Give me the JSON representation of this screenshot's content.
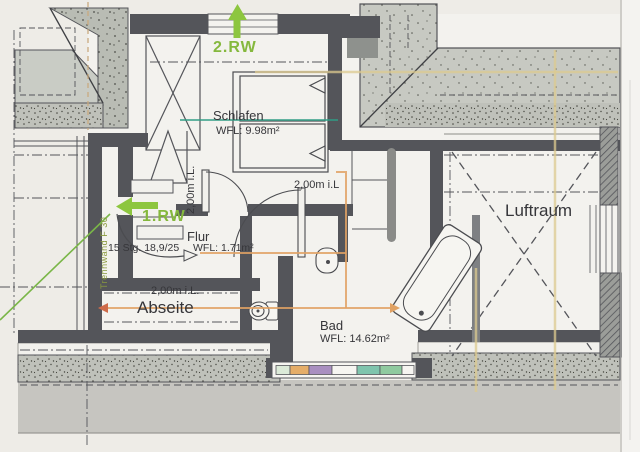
{
  "plan": {
    "rooms": {
      "schlafen": {
        "name": "Schlafen",
        "area": "WFL: 9.98m²",
        "clearance_horizontal": "2,00m i.L",
        "clearance_vertical": "2,00m i.L."
      },
      "flur": {
        "name": "Flur",
        "stair_note": "15 Stg. 18,9/25",
        "area": "WFL: 1.71m²"
      },
      "abseite": {
        "name": "Abseite",
        "clearance": "2,00m i.L."
      },
      "bad": {
        "name": "Bad",
        "area": "WFL: 14.62m²"
      },
      "luftraum": {
        "name": "Luftraum"
      }
    },
    "annotations": {
      "escape_route_1": "1.RW",
      "escape_route_2": "2.RW",
      "partition_wall": "Trennwand F 30"
    },
    "colors": {
      "paper": "#eeece7",
      "wall_dark": "#54555a",
      "concrete_light": "#c7c9c2",
      "concrete_mid": "#b9bcb4",
      "terrace_gray": "#c6c5c0",
      "escape_green": "#8dc63f",
      "highlight_orange": "#e0a264",
      "highlight_yellow": "#dcc98f",
      "highlight_teal": "#2f9e85",
      "highlight_purple": "#a98fc0",
      "highlight_green": "#8fca9f",
      "arrow_red": "#cf6b4a"
    }
  }
}
